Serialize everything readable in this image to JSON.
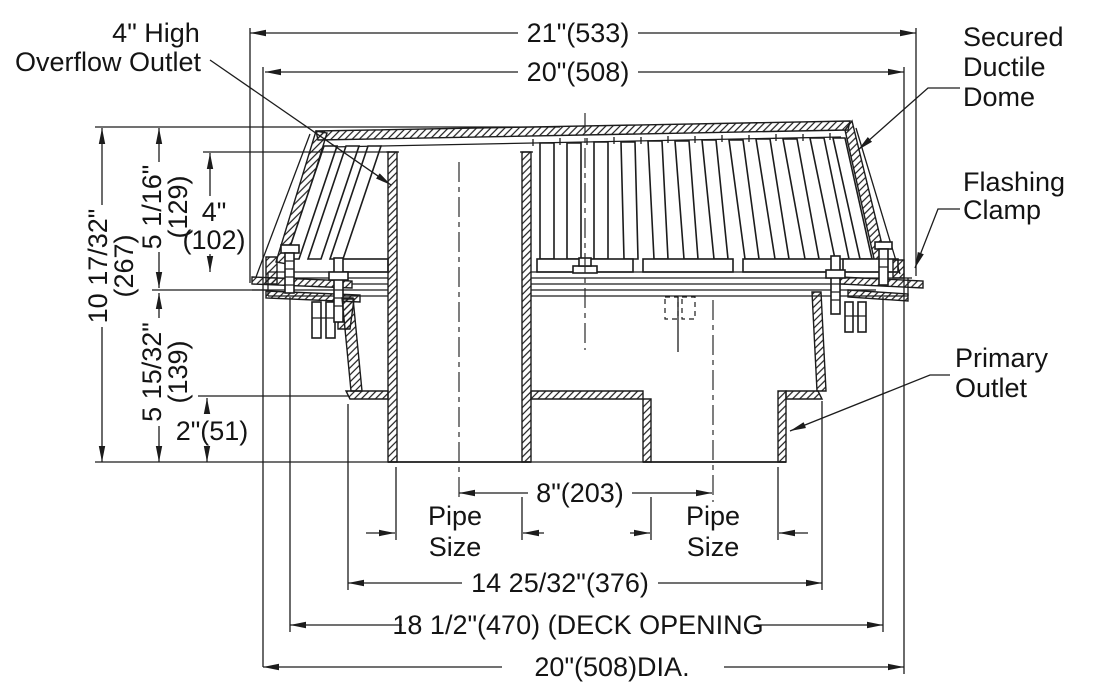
{
  "diagram": {
    "title": "Roof drain cross-section",
    "labels": {
      "overflow_line1": "4\" High",
      "overflow_line2": "Overflow Outlet",
      "dome_line1": "Secured",
      "dome_line2": "Ductile",
      "dome_line3": "Dome",
      "clamp_line1": "Flashing",
      "clamp_line2": "Clamp",
      "primary_line1": "Primary",
      "primary_line2": "Outlet",
      "pipe_left_line1": "Pipe",
      "pipe_left_line2": "Size",
      "pipe_right_line1": "Pipe",
      "pipe_right_line2": "Size"
    },
    "dims": {
      "top_width": "21\"(533)",
      "dome_width": "20\"(508)",
      "overall_height": [
        "10 17/32\"",
        "(267)"
      ],
      "upper_height": [
        "5 1/16\"",
        "(129)"
      ],
      "overflow_height": [
        "4\"",
        "(102)"
      ],
      "lower_height": [
        "5 15/32\"",
        "(139)"
      ],
      "outlet_stub": "2\"(51)",
      "outlet_spacing": "8\"(203)",
      "body_width": "14 25/32\"(376)",
      "deck_opening": "18 1/2\"(470)  (DECK OPENING",
      "bottom_diameter": "20\"(508)DIA."
    },
    "line_color": "#1c1c1c"
  }
}
